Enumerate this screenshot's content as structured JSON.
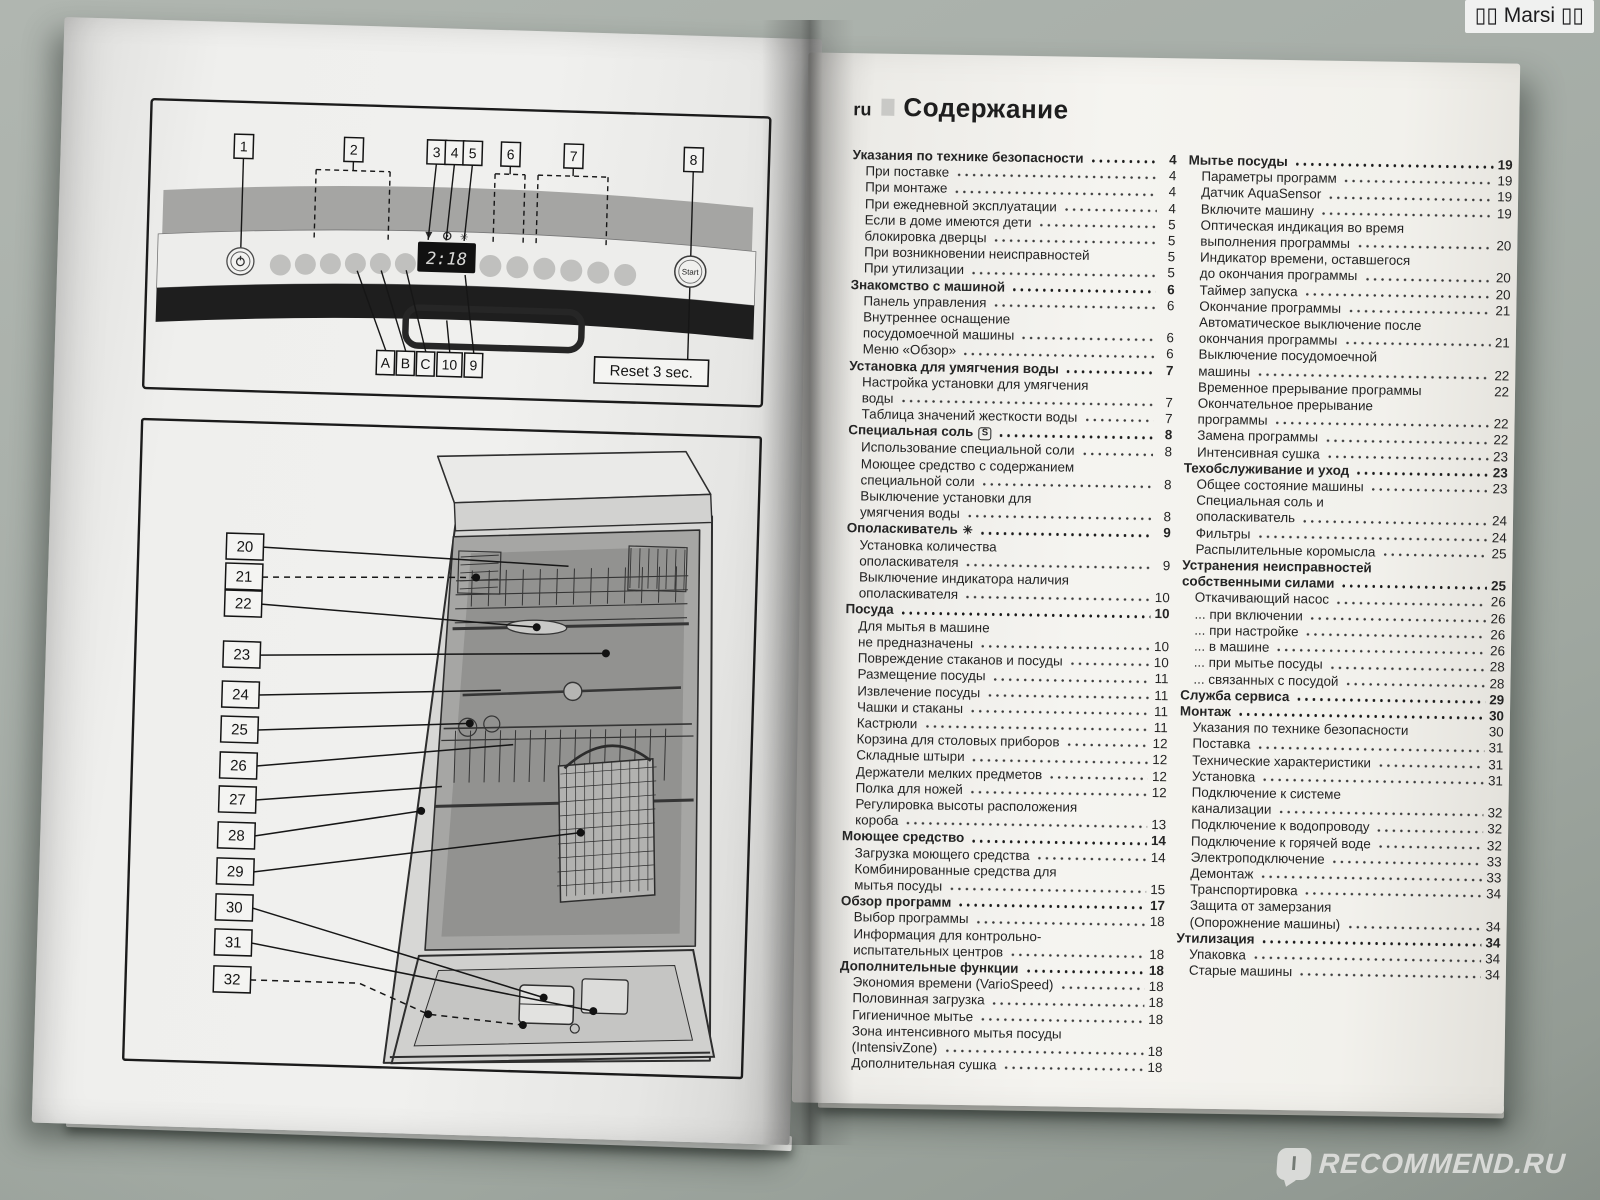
{
  "watermarks": {
    "top_text": "▯▯ Marsi ▯▯",
    "bottom_text": "RECOMMEND.RU",
    "bottom_icon": "I"
  },
  "left_page": {
    "panel": {
      "callouts_top": [
        "1",
        "2",
        "3",
        "4",
        "5",
        "6",
        "7",
        "8"
      ],
      "callouts_bottom": [
        "A",
        "B",
        "C",
        "10",
        "9"
      ],
      "reset_label": "Reset 3 sec.",
      "start_label": "Start",
      "display_value": "2:18",
      "indicator_icons": [
        "salt-refill-indicator",
        "rinse-aid-indicator",
        "water-supply-indicator"
      ],
      "power_icon": "power-symbol"
    },
    "interior": {
      "callouts": [
        "20",
        "21",
        "22",
        "23",
        "24",
        "25",
        "26",
        "27",
        "28",
        "29",
        "30",
        "31",
        "32"
      ]
    }
  },
  "right_page": {
    "lang_code": "ru",
    "title": "Содержание",
    "col1": [
      {
        "lines": [
          "Указания по технике безопасности"
        ],
        "page": "4",
        "bold": true,
        "dots": true
      },
      {
        "lines": [
          "При поставке"
        ],
        "page": "4",
        "sub": true,
        "dots": true
      },
      {
        "lines": [
          "При монтаже"
        ],
        "page": "4",
        "sub": true,
        "dots": true
      },
      {
        "lines": [
          "При ежедневной эксплуатации"
        ],
        "page": "4",
        "sub": true,
        "dots": true
      },
      {
        "lines": [
          "Если в доме имеются дети"
        ],
        "page": "5",
        "sub": true,
        "dots": true
      },
      {
        "lines": [
          "блокировка дверцы"
        ],
        "page": "5",
        "sub": true,
        "dots": true
      },
      {
        "lines": [
          "При возникновении неисправностей"
        ],
        "page": "5",
        "sub": true,
        "dots": false
      },
      {
        "lines": [
          "При утилизации"
        ],
        "page": "5",
        "sub": true,
        "dots": true
      },
      {
        "lines": [
          "Знакомство с машиной"
        ],
        "page": "6",
        "bold": true,
        "dots": true
      },
      {
        "lines": [
          "Панель управления"
        ],
        "page": "6",
        "sub": true,
        "dots": true
      },
      {
        "lines": [
          "Внутреннее оснащение",
          "посудомоечной машины"
        ],
        "page": "6",
        "sub": true,
        "dots": true
      },
      {
        "lines": [
          "Меню «Обзор»"
        ],
        "page": "6",
        "sub": true,
        "dots": true
      },
      {
        "lines": [
          "Установка для умягчения воды"
        ],
        "page": "7",
        "bold": true,
        "dots": true
      },
      {
        "lines": [
          "Настройка установки для умягчения",
          "воды"
        ],
        "page": "7",
        "sub": true,
        "dots": true
      },
      {
        "lines": [
          "Таблица значений жесткости воды"
        ],
        "page": "7",
        "sub": true,
        "dots": true
      },
      {
        "lines": [
          "Специальная соль"
        ],
        "page": "8",
        "bold": true,
        "dots": true,
        "icon": "salt"
      },
      {
        "lines": [
          "Использование специальной соли"
        ],
        "page": "8",
        "sub": true,
        "dots": true
      },
      {
        "lines": [
          "Моющее средство с содержанием",
          "специальной соли"
        ],
        "page": "8",
        "sub": true,
        "dots": true
      },
      {
        "lines": [
          "Выключение установки для",
          "умягчения воды"
        ],
        "page": "8",
        "sub": true,
        "dots": true
      },
      {
        "lines": [
          "Ополаскиватель"
        ],
        "page": "9",
        "bold": true,
        "dots": true,
        "icon": "star"
      },
      {
        "lines": [
          "Установка количества",
          "ополаскивателя"
        ],
        "page": "9",
        "sub": true,
        "dots": true
      },
      {
        "lines": [
          "Выключение индикатора наличия",
          "ополаскивателя"
        ],
        "page": "10",
        "sub": true,
        "dots": true
      },
      {
        "lines": [
          "Посуда"
        ],
        "page": "10",
        "bold": true,
        "dots": true
      },
      {
        "lines": [
          "Для мытья в машине",
          "не предназначены"
        ],
        "page": "10",
        "sub": true,
        "dots": true
      },
      {
        "lines": [
          "Повреждение стаканов и посуды"
        ],
        "page": "10",
        "sub": true,
        "dots": true
      },
      {
        "lines": [
          "Размещение посуды"
        ],
        "page": "11",
        "sub": true,
        "dots": true
      },
      {
        "lines": [
          "Извлечение посуды"
        ],
        "page": "11",
        "sub": true,
        "dots": true
      },
      {
        "lines": [
          "Чашки и стаканы"
        ],
        "page": "11",
        "sub": true,
        "dots": true
      },
      {
        "lines": [
          "Кастрюли"
        ],
        "page": "11",
        "sub": true,
        "dots": true
      },
      {
        "lines": [
          "Корзина для столовых приборов"
        ],
        "page": "12",
        "sub": true,
        "dots": true
      },
      {
        "lines": [
          "Складные штыри"
        ],
        "page": "12",
        "sub": true,
        "dots": true
      },
      {
        "lines": [
          "Держатели мелких предметов"
        ],
        "page": "12",
        "sub": true,
        "dots": true
      },
      {
        "lines": [
          "Полка для ножей"
        ],
        "page": "12",
        "sub": true,
        "dots": true
      },
      {
        "lines": [
          "Регулировка высоты расположения",
          "короба"
        ],
        "page": "13",
        "sub": true,
        "dots": true
      },
      {
        "lines": [
          "Моющее средство"
        ],
        "page": "14",
        "bold": true,
        "dots": true
      },
      {
        "lines": [
          "Загрузка моющего средства"
        ],
        "page": "14",
        "sub": true,
        "dots": true
      },
      {
        "lines": [
          "Комбинированные средства для",
          "мытья посуды"
        ],
        "page": "15",
        "sub": true,
        "dots": true
      },
      {
        "lines": [
          "Обзор программ"
        ],
        "page": "17",
        "bold": true,
        "dots": true
      },
      {
        "lines": [
          "Выбор программы"
        ],
        "page": "18",
        "sub": true,
        "dots": true
      },
      {
        "lines": [
          "Информация для контрольно-",
          "испытательных центров"
        ],
        "page": "18",
        "sub": true,
        "dots": true
      },
      {
        "lines": [
          "Дополнительные функции"
        ],
        "page": "18",
        "bold": true,
        "dots": true
      },
      {
        "lines": [
          "Экономия времени (VarioSpeed)"
        ],
        "page": "18",
        "sub": true,
        "dots": true
      },
      {
        "lines": [
          "Половинная загрузка"
        ],
        "page": "18",
        "sub": true,
        "dots": true
      },
      {
        "lines": [
          "Гигиеничное мытье"
        ],
        "page": "18",
        "sub": true,
        "dots": true
      },
      {
        "lines": [
          "Зона интенсивного мытья посуды",
          "(IntensivZone)"
        ],
        "page": "18",
        "sub": true,
        "dots": true
      },
      {
        "lines": [
          "Дополнительная сушка"
        ],
        "page": "18",
        "sub": true,
        "dots": true
      }
    ],
    "col2": [
      {
        "lines": [
          "Мытье посуды"
        ],
        "page": "19",
        "bold": true,
        "dots": true
      },
      {
        "lines": [
          "Параметры программ"
        ],
        "page": "19",
        "sub": true,
        "dots": true
      },
      {
        "lines": [
          "Датчик AquaSensor"
        ],
        "page": "19",
        "sub": true,
        "dots": true
      },
      {
        "lines": [
          "Включите машину"
        ],
        "page": "19",
        "sub": true,
        "dots": true
      },
      {
        "lines": [
          "Оптическая индикация во время",
          "выполнения программы"
        ],
        "page": "20",
        "sub": true,
        "dots": true
      },
      {
        "lines": [
          "Индикатор времени, оставшегося",
          "до окончания программы"
        ],
        "page": "20",
        "sub": true,
        "dots": true
      },
      {
        "lines": [
          "Таймер запуска"
        ],
        "page": "20",
        "sub": true,
        "dots": true
      },
      {
        "lines": [
          "Окончание программы"
        ],
        "page": "21",
        "sub": true,
        "dots": true
      },
      {
        "lines": [
          "Автоматическое выключение после",
          "окончания программы"
        ],
        "page": "21",
        "sub": true,
        "dots": true
      },
      {
        "lines": [
          "Выключение посудомоечной",
          "машины"
        ],
        "page": "22",
        "sub": true,
        "dots": true
      },
      {
        "lines": [
          "Временное прерывание программы"
        ],
        "page": "22",
        "sub": true,
        "dots": false
      },
      {
        "lines": [
          "Окончательное прерывание",
          "программы"
        ],
        "page": "22",
        "sub": true,
        "dots": true
      },
      {
        "lines": [
          "Замена программы"
        ],
        "page": "22",
        "sub": true,
        "dots": true
      },
      {
        "lines": [
          "Интенсивная сушка"
        ],
        "page": "23",
        "sub": true,
        "dots": true
      },
      {
        "lines": [
          "Техобслуживание и уход"
        ],
        "page": "23",
        "bold": true,
        "dots": true
      },
      {
        "lines": [
          "Общее состояние машины"
        ],
        "page": "23",
        "sub": true,
        "dots": true
      },
      {
        "lines": [
          "Специальная соль и",
          "ополаскиватель"
        ],
        "page": "24",
        "sub": true,
        "dots": true
      },
      {
        "lines": [
          "Фильтры"
        ],
        "page": "24",
        "sub": true,
        "dots": true
      },
      {
        "lines": [
          "Распылительные коромысла"
        ],
        "page": "25",
        "sub": true,
        "dots": true
      },
      {
        "lines": [
          "Устранения неисправностей",
          "собственными силами"
        ],
        "page": "25",
        "bold": true,
        "dots": true
      },
      {
        "lines": [
          "Откачивающий насос"
        ],
        "page": "26",
        "sub": true,
        "dots": true
      },
      {
        "lines": [
          "... при включении"
        ],
        "page": "26",
        "sub": true,
        "dots": true
      },
      {
        "lines": [
          "... при настройке"
        ],
        "page": "26",
        "sub": true,
        "dots": true
      },
      {
        "lines": [
          "... в машине"
        ],
        "page": "26",
        "sub": true,
        "dots": true
      },
      {
        "lines": [
          "... при мытье посуды"
        ],
        "page": "28",
        "sub": true,
        "dots": true
      },
      {
        "lines": [
          "... связанных с посудой"
        ],
        "page": "28",
        "sub": true,
        "dots": true
      },
      {
        "lines": [
          "Служба сервиса"
        ],
        "page": "29",
        "bold": true,
        "dots": true
      },
      {
        "lines": [
          "Монтаж"
        ],
        "page": "30",
        "bold": true,
        "dots": true
      },
      {
        "lines": [
          "Указания по технике безопасности"
        ],
        "page": "30",
        "sub": true,
        "dots": false
      },
      {
        "lines": [
          "Поставка"
        ],
        "page": "31",
        "sub": true,
        "dots": true
      },
      {
        "lines": [
          "Технические характеристики"
        ],
        "page": "31",
        "sub": true,
        "dots": true
      },
      {
        "lines": [
          "Установка"
        ],
        "page": "31",
        "sub": true,
        "dots": true
      },
      {
        "lines": [
          "Подключение к системе",
          "канализации"
        ],
        "page": "32",
        "sub": true,
        "dots": true
      },
      {
        "lines": [
          "Подключение к водопроводу"
        ],
        "page": "32",
        "sub": true,
        "dots": true
      },
      {
        "lines": [
          "Подключение к горячей воде"
        ],
        "page": "32",
        "sub": true,
        "dots": true
      },
      {
        "lines": [
          "Электроподключение"
        ],
        "page": "33",
        "sub": true,
        "dots": true
      },
      {
        "lines": [
          "Демонтаж"
        ],
        "page": "33",
        "sub": true,
        "dots": true
      },
      {
        "lines": [
          "Транспортировка"
        ],
        "page": "34",
        "sub": true,
        "dots": true
      },
      {
        "lines": [
          "Защита от замерзания",
          "(Опорожнение машины)"
        ],
        "page": "34",
        "sub": true,
        "dots": true
      },
      {
        "lines": [
          "Утилизация"
        ],
        "page": "34",
        "bold": true,
        "dots": true
      },
      {
        "lines": [
          "Упаковка"
        ],
        "page": "34",
        "sub": true,
        "dots": true
      },
      {
        "lines": [
          "Старые машины"
        ],
        "page": "34",
        "sub": true,
        "dots": true
      }
    ]
  }
}
